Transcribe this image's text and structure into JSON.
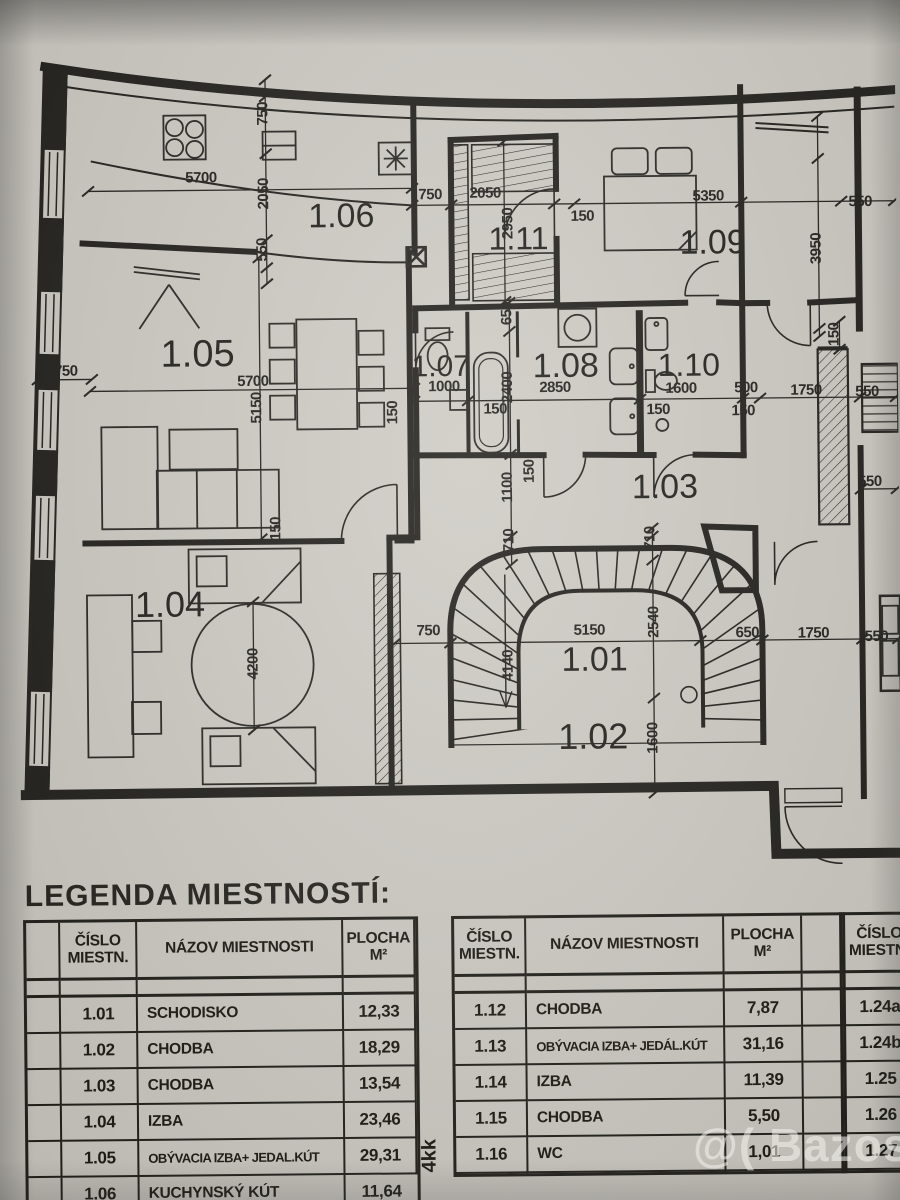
{
  "photo": {
    "watermark": "@( Bazos.sk"
  },
  "plan": {
    "room_labels": [
      {
        "t": "1.06",
        "x": 345,
        "y": 226,
        "s": 34
      },
      {
        "t": "1.11",
        "x": 522,
        "y": 250,
        "s": 32
      },
      {
        "t": "1.09",
        "x": 716,
        "y": 256,
        "s": 34
      },
      {
        "t": "1.05",
        "x": 200,
        "y": 364,
        "s": 38
      },
      {
        "t": "1.07",
        "x": 443,
        "y": 376,
        "s": 30
      },
      {
        "t": "1.08",
        "x": 568,
        "y": 378,
        "s": 34
      },
      {
        "t": "1.10",
        "x": 691,
        "y": 378,
        "s": 32
      },
      {
        "t": "1.03",
        "x": 666,
        "y": 500,
        "s": 34
      },
      {
        "t": "1.04",
        "x": 170,
        "y": 614,
        "s": 36
      },
      {
        "t": "1.01",
        "x": 594,
        "y": 672,
        "s": 34
      },
      {
        "t": "1.02",
        "x": 592,
        "y": 750,
        "s": 36
      }
    ],
    "dimensions": [
      {
        "t": "750",
        "x": 272,
        "y": 112,
        "r": 90
      },
      {
        "t": "2050",
        "x": 272,
        "y": 192,
        "r": 90
      },
      {
        "t": "550",
        "x": 270,
        "y": 248,
        "r": 90
      },
      {
        "t": "5700",
        "x": 205,
        "y": 180,
        "r": 0
      },
      {
        "t": "750",
        "x": 434,
        "y": 199,
        "r": 0
      },
      {
        "t": "2050",
        "x": 489,
        "y": 198,
        "r": 0
      },
      {
        "t": "2950",
        "x": 516,
        "y": 224,
        "r": 90
      },
      {
        "t": "150",
        "x": 586,
        "y": 222,
        "r": 0
      },
      {
        "t": "5350",
        "x": 712,
        "y": 203,
        "r": 0
      },
      {
        "t": "550",
        "x": 864,
        "y": 210,
        "r": 0
      },
      {
        "t": "3950",
        "x": 824,
        "y": 252,
        "r": 90
      },
      {
        "t": "650",
        "x": 514,
        "y": 314,
        "r": 90
      },
      {
        "t": "750",
        "x": 68,
        "y": 372,
        "r": 0
      },
      {
        "t": "5700",
        "x": 255,
        "y": 384,
        "r": 0
      },
      {
        "t": "5150",
        "x": 263,
        "y": 406,
        "r": 90
      },
      {
        "t": "1000",
        "x": 446,
        "y": 391,
        "r": 0
      },
      {
        "t": "2400",
        "x": 514,
        "y": 388,
        "r": 90
      },
      {
        "t": "2850",
        "x": 557,
        "y": 393,
        "r": 0
      },
      {
        "t": "150",
        "x": 497,
        "y": 414,
        "r": 0
      },
      {
        "t": "1600",
        "x": 683,
        "y": 395,
        "r": 0
      },
      {
        "t": "150",
        "x": 660,
        "y": 416,
        "r": 0
      },
      {
        "t": "500",
        "x": 748,
        "y": 395,
        "r": 0
      },
      {
        "t": "150",
        "x": 745,
        "y": 418,
        "r": 0
      },
      {
        "t": "1750",
        "x": 808,
        "y": 398,
        "r": 0
      },
      {
        "t": "550",
        "x": 869,
        "y": 400,
        "r": 0
      },
      {
        "t": "150",
        "x": 841,
        "y": 338,
        "r": 90
      },
      {
        "t": "150",
        "x": 399,
        "y": 412,
        "r": 90
      },
      {
        "t": "150",
        "x": 281,
        "y": 527,
        "r": 90
      },
      {
        "t": "1100",
        "x": 513,
        "y": 488,
        "r": 90
      },
      {
        "t": "150",
        "x": 535,
        "y": 472,
        "r": 90
      },
      {
        "t": "550",
        "x": 871,
        "y": 490,
        "r": 0
      },
      {
        "t": "710",
        "x": 514,
        "y": 541,
        "r": 90
      },
      {
        "t": "710",
        "x": 655,
        "y": 540,
        "r": 90
      },
      {
        "t": "750",
        "x": 428,
        "y": 635,
        "r": 0
      },
      {
        "t": "5150",
        "x": 589,
        "y": 636,
        "r": 0
      },
      {
        "t": "2540",
        "x": 658,
        "y": 624,
        "r": 90
      },
      {
        "t": "4140",
        "x": 512,
        "y": 666,
        "r": 90
      },
      {
        "t": "650",
        "x": 747,
        "y": 640,
        "r": 0
      },
      {
        "t": "1750",
        "x": 813,
        "y": 641,
        "r": 0
      },
      {
        "t": "550",
        "x": 876,
        "y": 645,
        "r": 0
      },
      {
        "t": "1600",
        "x": 656,
        "y": 740,
        "r": 90
      },
      {
        "t": "4200",
        "x": 257,
        "y": 662,
        "r": 90
      }
    ]
  },
  "legend": {
    "title": "LEGENDA MIESTNOSTÍ:",
    "side_note": "4kk",
    "header": {
      "num": [
        "ČÍSLO",
        "MIESTN."
      ],
      "name": "NÁZOV MIESTNOSTI",
      "area": [
        "PLOCHA",
        "M²"
      ]
    },
    "tables": [
      {
        "rows": [
          [
            "1.01",
            "SCHODISKO",
            "12,33"
          ],
          [
            "1.02",
            "CHODBA",
            "18,29"
          ],
          [
            "1.03",
            "CHODBA",
            "13,54"
          ],
          [
            "1.04",
            "IZBA",
            "23,46"
          ],
          [
            "1.05",
            "OBÝVACIA IZBA+ JEDAL.KÚT",
            "29,31"
          ],
          [
            "1.06",
            "KUCHYNSKÝ KÚT",
            "11,64"
          ]
        ]
      },
      {
        "rows": [
          [
            "1.12",
            "CHODBA",
            "7,87"
          ],
          [
            "1.13",
            "OBÝVACIA IZBA+ JEDÁL.KÚT",
            "31,16"
          ],
          [
            "1.14",
            "IZBA",
            "11,39"
          ],
          [
            "1.15",
            "CHODBA",
            "5,50"
          ],
          [
            "1.16",
            "WC",
            "1,01"
          ]
        ]
      },
      {
        "rows": [
          [
            "1.24a",
            "",
            ""
          ],
          [
            "1.24b",
            "",
            ""
          ],
          [
            "1.25",
            "",
            ""
          ],
          [
            "1.26",
            "",
            ""
          ],
          [
            "1.27",
            "",
            ""
          ]
        ]
      }
    ]
  }
}
